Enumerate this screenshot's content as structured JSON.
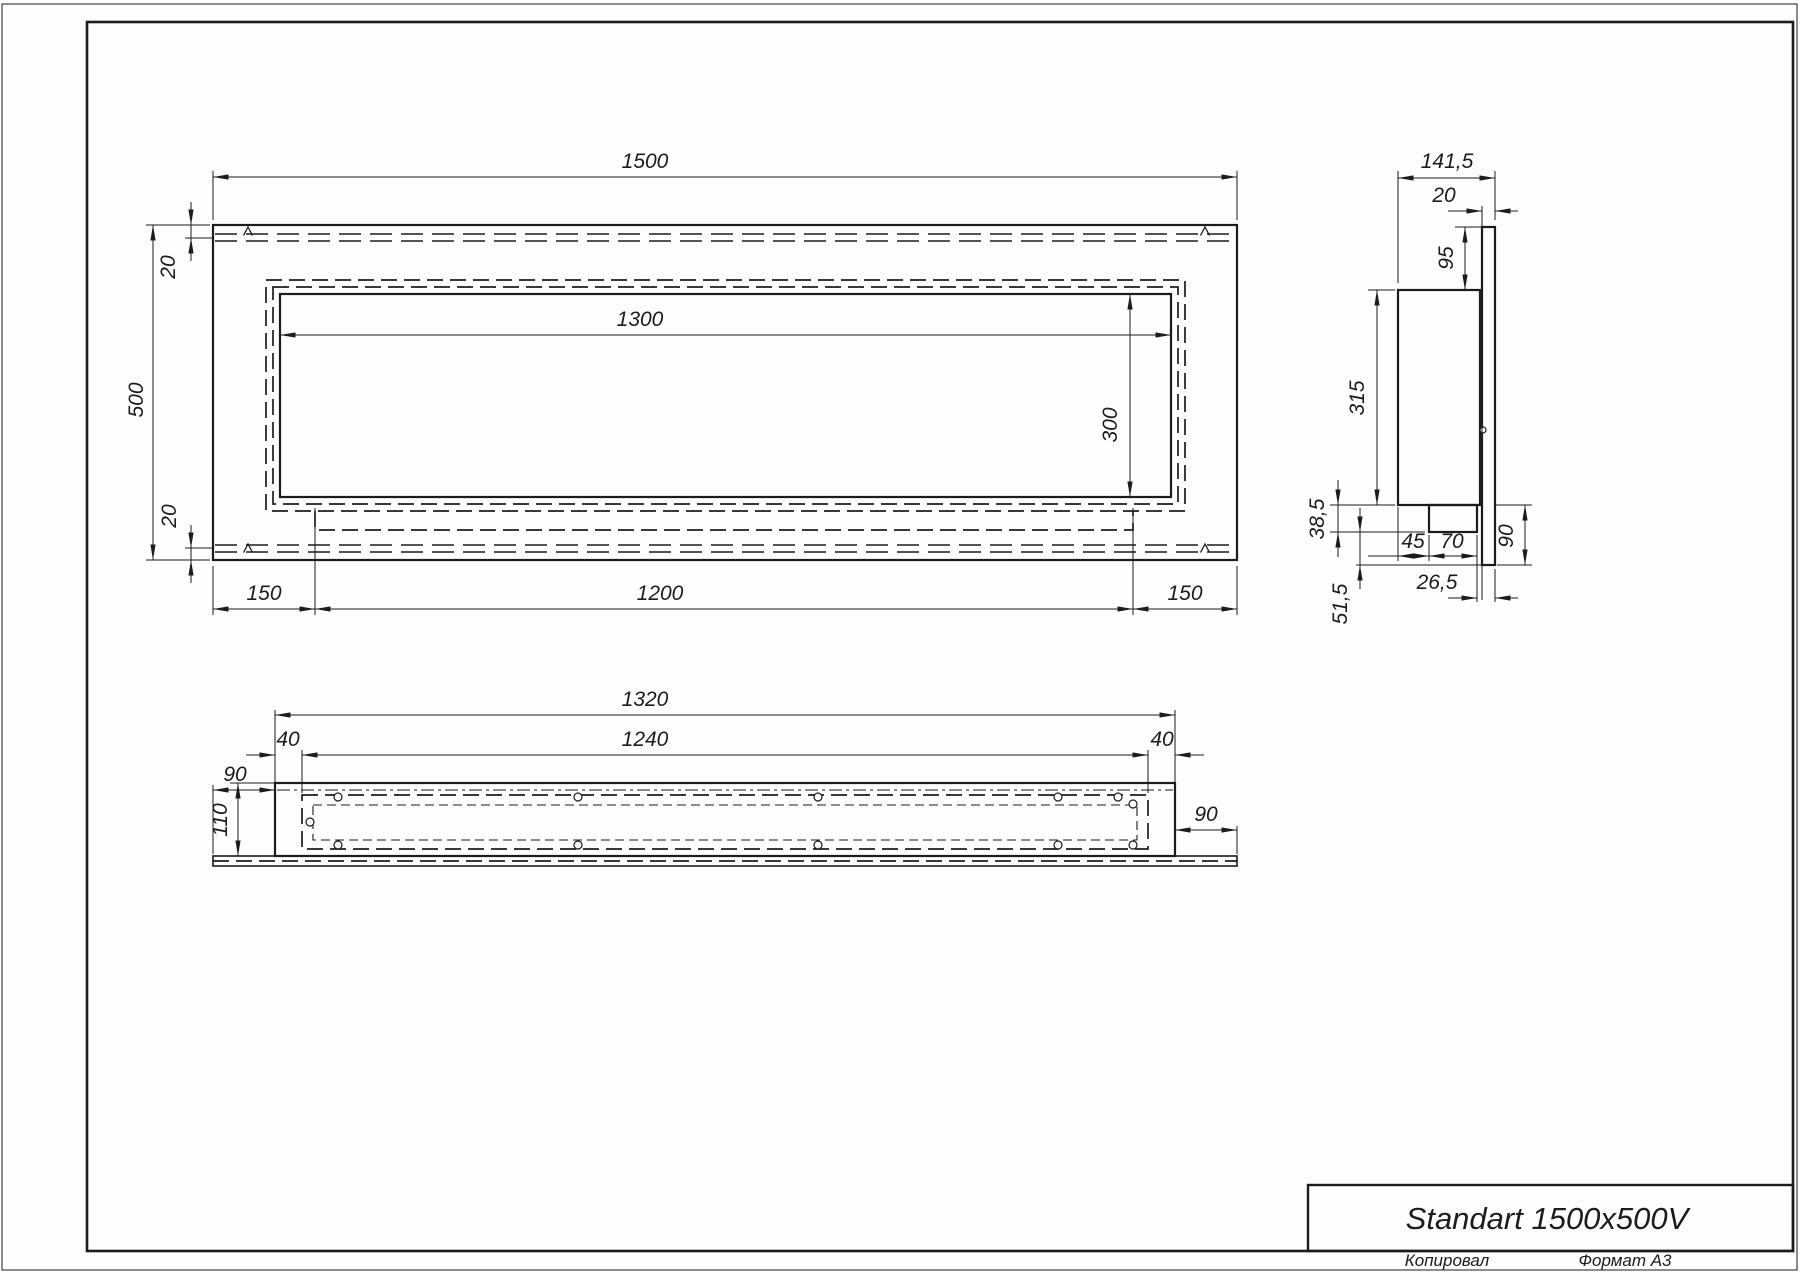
{
  "title_block": {
    "title": "Standart 1500x500V",
    "copied": "Копировал",
    "format": "Формат А3"
  },
  "views": {
    "front": {
      "dims": {
        "overall_width": "1500",
        "overall_height": "500",
        "top_offset": "20",
        "bottom_offset": "20",
        "opening_width": "1300",
        "opening_height": "300",
        "left_margin": "150",
        "tray_width": "1200",
        "right_margin": "150"
      }
    },
    "side": {
      "dims": {
        "overall_depth": "141,5",
        "panel_thickness": "20",
        "top_height": "95",
        "body_height": "315",
        "tray_height": "38,5",
        "burner_offset": "45",
        "burner_width": "70",
        "flange_height": "90",
        "edge_offset": "26,5",
        "bottom_height": "51,5"
      }
    },
    "bottom": {
      "dims": {
        "box_length": "1320",
        "opening_length": "1240",
        "left_inset": "40",
        "right_inset": "40",
        "left_flange": "90",
        "depth": "110",
        "right_flange": "90"
      }
    }
  }
}
